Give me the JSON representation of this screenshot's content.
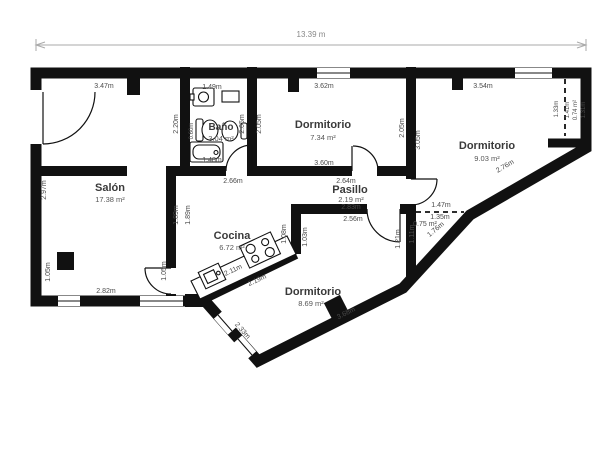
{
  "title": "floor-plan",
  "colors": {
    "wall": "#111111",
    "floor": "#ffffff",
    "dimension_text": "#4a4a4a",
    "room_text": "#3a3a3a",
    "dimension_line": "#aaaaaa"
  },
  "scale": {
    "total_width": "13.39 m"
  },
  "rooms": {
    "salon": {
      "name": "Salón",
      "area": "17.38 m²"
    },
    "bano": {
      "name": "Baño",
      "area": "3.04 m²"
    },
    "dorm1": {
      "name": "Dormitorio",
      "area": "7.34 m²"
    },
    "dorm2": {
      "name": "Dormitorio",
      "area": "9.03 m²"
    },
    "dorm3": {
      "name": "Dormitorio",
      "area": "8.69 m²"
    },
    "pasillo": {
      "name": "Pasillo",
      "area": "2.19 m²"
    },
    "cocina": {
      "name": "Cocina",
      "area": "6.72 m²"
    },
    "closet_top": {
      "area": "0.74 m²"
    },
    "closet_mid": {
      "area": "0.75 m²"
    }
  },
  "dims": {
    "total": "13.39 m",
    "salon_top": "3.47m",
    "salon_left": "2.97m",
    "salon_bottom": "2.82m",
    "salon_bottom_left": "1.05m",
    "salon_bottom_right": "1.05m",
    "salon_kitchen_wall_a": "1.89m",
    "salon_kitchen_wall_b": "1.89m",
    "bano_top": "1.49m",
    "bano_left": "2.20m",
    "bano_toilet": "0.60m",
    "bano_bath": "1.48m",
    "bano_right": "2.05m",
    "bano_bottom": "2.66m",
    "dorm1_left": "2.05m",
    "dorm1_top": "3.62m",
    "dorm1_bottom": "3.60m",
    "dorm1_right": "2.05m",
    "dorm2_left": "3.05m",
    "dorm2_top": "3.54m",
    "dorm2_diagonal": "2.76m",
    "closet_top_open": "1.33m",
    "closet_top_height": "1.41m",
    "closet_top_right": "1.31m",
    "pasillo_top": "2.64m",
    "pasillo_length": "2.83m",
    "pasillo_bottom": "2.56m",
    "closet_mid_top": "1.47m",
    "closet_mid_open": "1.35m",
    "closet_mid_left": "1.21m",
    "closet_mid_right": "1.11m",
    "closet_mid_diagonal": "1.76m",
    "cocina_wall_west": "1.08m",
    "cocina_wall_east": "1.03m",
    "counter_upper": "2.11m",
    "counter_lower": "2.19m",
    "dorm3_window": "2.33m",
    "dorm3_diagonal": "3.68m"
  }
}
